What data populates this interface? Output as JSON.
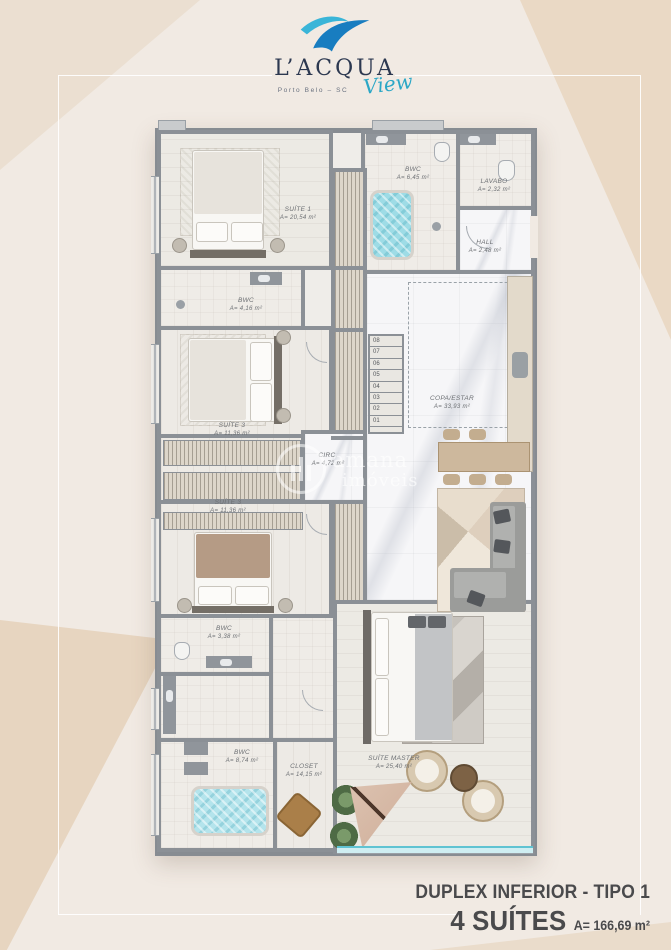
{
  "logo": {
    "brand": "L’ACQUA",
    "sub": "Porto Belo – SC",
    "script": "View"
  },
  "watermark": {
    "line1": "amana",
    "line2": "imóveis"
  },
  "rooms": {
    "suite1": {
      "name": "SUÍTE 1",
      "area": "A= 20,54 m²"
    },
    "bwc1": {
      "name": "BWC",
      "area": "A= 4,16 m²"
    },
    "suite2": {
      "name": "SUÍTE 3",
      "area": "A= 11,36 m²"
    },
    "suite3": {
      "name": "SUÍTE 3",
      "area": "A= 11,36 m²"
    },
    "bwc2": {
      "name": "BWC",
      "area": "A= 3,38 m²"
    },
    "bwc3": {
      "name": "BWC",
      "area": "A= 8,74 m²"
    },
    "closet": {
      "name": "CLOSET",
      "area": "A= 14,15 m²"
    },
    "master": {
      "name": "SUÍTE MASTER",
      "area": "A= 25,40 m²"
    },
    "bwcTop": {
      "name": "BWC",
      "area": "A= 6,45 m²"
    },
    "lavabo": {
      "name": "LAVABO",
      "area": "A= 2,32 m²"
    },
    "hall": {
      "name": "HALL",
      "area": "A= 2,48 m²"
    },
    "copa": {
      "name": "COPA/ESTAR",
      "area": "A= 33,93 m²"
    },
    "circ": {
      "name": "CIRC.",
      "area": "A= 4,72 m²"
    }
  },
  "stairs": {
    "steps": [
      "08",
      "07",
      "06",
      "05",
      "04",
      "03",
      "02",
      "01"
    ]
  },
  "footer": {
    "title": "DUPLEX INFERIOR - TIPO 1",
    "suites": "4 SUÍTES",
    "area": "A= 166,69 m²"
  },
  "colors": {
    "accent_teal": "#2ba7c6",
    "logo_navy": "#2c3850",
    "water": "#9edce6",
    "background_cream": "#f1eae3",
    "background_beige": "#e9d9c6",
    "wall_gray": "#8b9096",
    "glass_teal": "#5fc3d2",
    "label_gray": "#6d7074",
    "footer_text": "#4a4a4c"
  }
}
